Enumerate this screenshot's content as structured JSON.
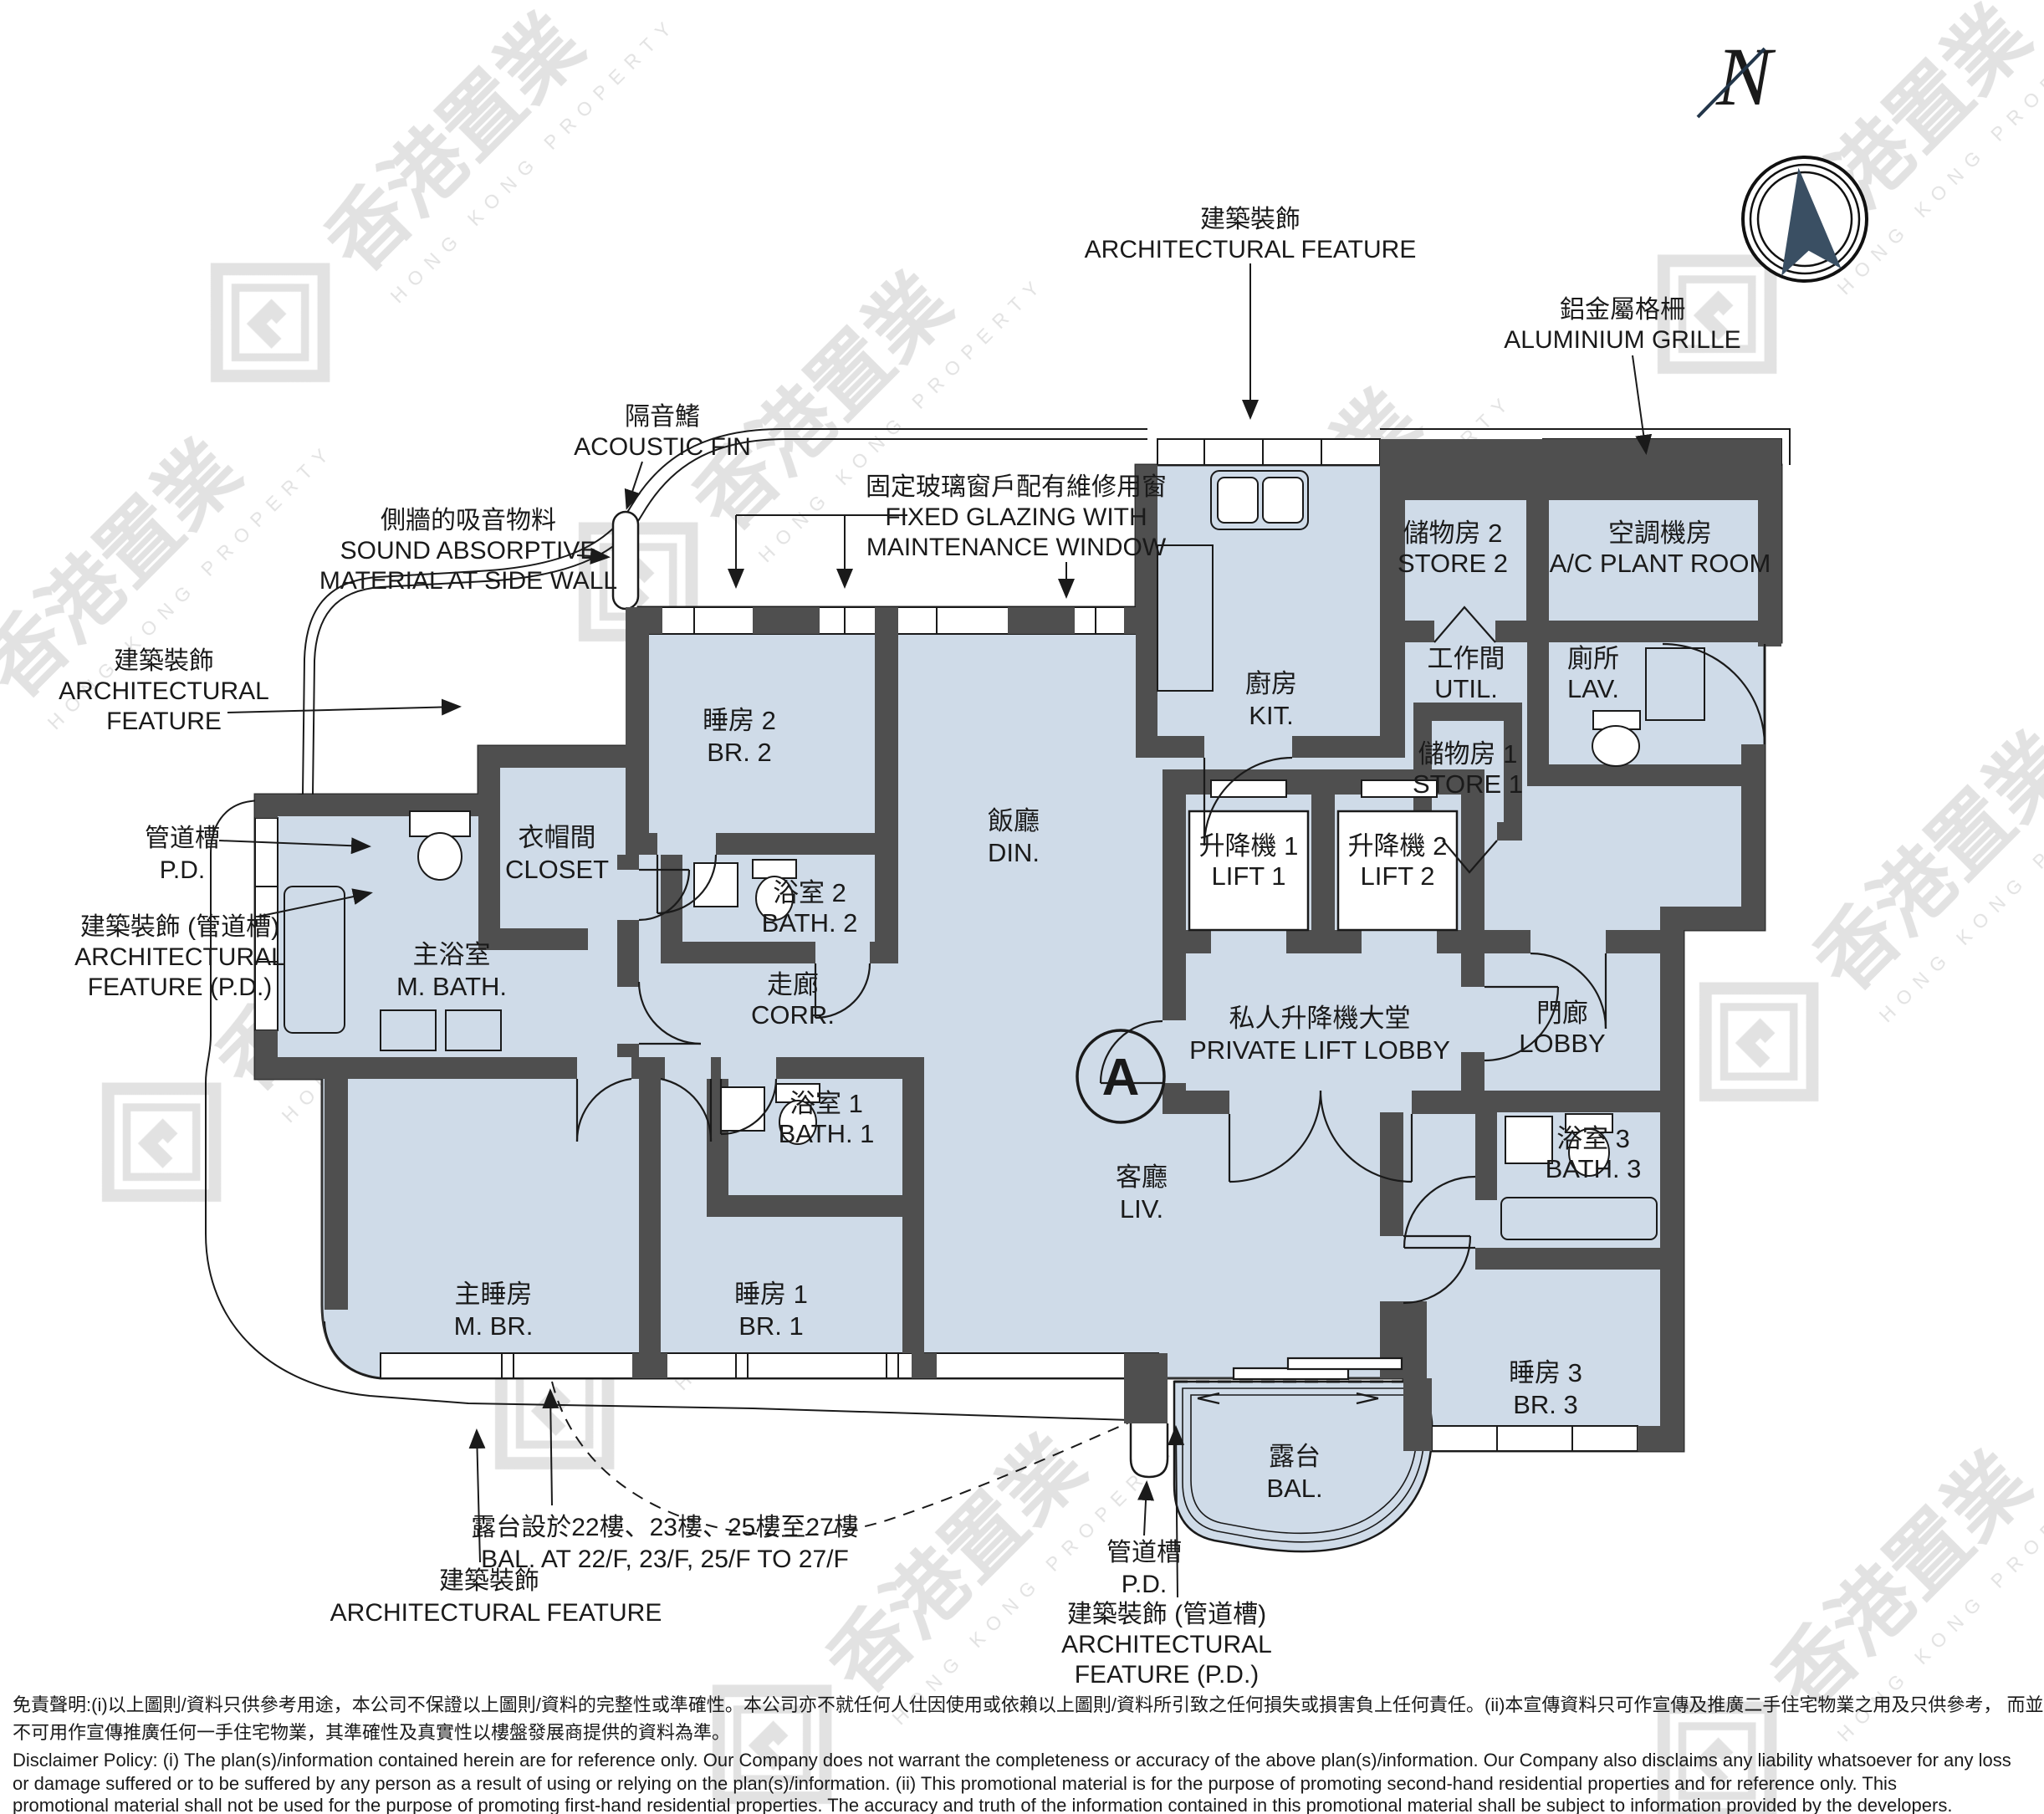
{
  "unit": {
    "marker": "A"
  },
  "compass": {
    "n": "N"
  },
  "watermark": {
    "cjk": "香港置業",
    "en": "HONG KONG PROPERTY"
  },
  "colors": {
    "floor": "#cfdbe8",
    "wall": "#4f4f4f",
    "needle": "#3a4f63",
    "line": "#1a1a1a"
  },
  "rooms": {
    "kit": {
      "zh": "廚房",
      "en": "KIT."
    },
    "store2": {
      "zh": "儲物房 2",
      "en": "STORE 2"
    },
    "acpr": {
      "zh": "空調機房",
      "en": "A/C PLANT ROOM"
    },
    "util": {
      "zh": "工作間",
      "en": "UTIL."
    },
    "lav": {
      "zh": "廁所",
      "en": "LAV."
    },
    "store1": {
      "zh": "儲物房 1",
      "en": "STORE 1"
    },
    "br2": {
      "zh": "睡房 2",
      "en": "BR. 2"
    },
    "din": {
      "zh": "飯廳",
      "en": "DIN."
    },
    "closet": {
      "zh": "衣帽間",
      "en": "CLOSET"
    },
    "mbath": {
      "zh": "主浴室",
      "en": "M. BATH."
    },
    "bath2": {
      "zh": "浴室 2",
      "en": "BATH. 2"
    },
    "corr": {
      "zh": "走廊",
      "en": "CORR."
    },
    "lift1": {
      "zh": "升降機 1",
      "en": "LIFT 1"
    },
    "lift2": {
      "zh": "升降機 2",
      "en": "LIFT 2"
    },
    "pll": {
      "zh": "私人升降機大堂",
      "en": "PRIVATE LIFT LOBBY"
    },
    "lobby": {
      "zh": "門廊",
      "en": "LOBBY"
    },
    "bath3": {
      "zh": "浴室 3",
      "en": "BATH. 3"
    },
    "bath1": {
      "zh": "浴室 1",
      "en": "BATH. 1"
    },
    "mbr": {
      "zh": "主睡房",
      "en": "M. BR."
    },
    "br1": {
      "zh": "睡房 1",
      "en": "BR. 1"
    },
    "liv": {
      "zh": "客廳",
      "en": "LIV."
    },
    "br3": {
      "zh": "睡房 3",
      "en": "BR. 3"
    },
    "bal": {
      "zh": "露台",
      "en": "BAL."
    }
  },
  "annotations": {
    "af_top": {
      "zh": "建築裝飾",
      "en": "ARCHITECTURAL FEATURE"
    },
    "alu_grille": {
      "zh": "鋁金屬格柵",
      "en": "ALUMINIUM GRILLE"
    },
    "acoustic": {
      "zh": "隔音鰭",
      "en": "ACOUSTIC FIN"
    },
    "fixed_glz": {
      "zh": "固定玻璃窗戶配有維修用窗",
      "en1": "FIXED GLAZING WITH",
      "en2": "MAINTENANCE WINDOW"
    },
    "sound_abs": {
      "zh": "側牆的吸音物料",
      "en1": "SOUND ABSORPTIVE",
      "en2": "MATERIAL AT SIDE WALL"
    },
    "af_left": {
      "zh": "建築裝飾",
      "en1": "ARCHITECTURAL",
      "en2": "FEATURE"
    },
    "pd_left": {
      "zh": "管道槽",
      "en": "P.D."
    },
    "afpd_left": {
      "zh": "建築裝飾 (管道槽)",
      "en1": "ARCHITECTURAL",
      "en2": "FEATURE (P.D.)"
    },
    "af_bottom": {
      "zh": "建築裝飾",
      "en": "ARCHITECTURAL FEATURE"
    },
    "bal_at": {
      "zh": "露台設於22樓、23樓、25樓至27樓",
      "en": "BAL. AT 22/F, 23/F, 25/F TO 27/F"
    },
    "pd_bottom": {
      "zh": "管道槽",
      "en": "P.D."
    },
    "afpd_bottom": {
      "zh": "建築裝飾 (管道槽)",
      "en1": "ARCHITECTURAL",
      "en2": "FEATURE (P.D.)"
    }
  },
  "disclaimer": {
    "zh1": "免責聲明:(i)以上圖則/資料只供參考用途，本公司不保證以上圖則/資料的完整性或準確性。本公司亦不就任何人仕因使用或依賴以上圖則/資料所引致之任何損失或損害負上任何責任。(ii)本宣傳資料只可作宣傳及推廣二手住宅物業之用及只供參考， 而並非及",
    "zh2": "不可用作宣傳推廣任何一手住宅物業，其準確性及真實性以樓盤發展商提供的資料為準。",
    "en1": "Disclaimer Policy: (i) The plan(s)/information contained herein are for reference only. Our Company does not warrant the completeness or accuracy of the above plan(s)/information. Our Company also disclaims any liability whatsoever for any loss",
    "en2": "or damage suffered or to be suffered by any person as a result of using or relying on the plan(s)/information. (ii) This promotional material is for the purpose of promoting second-hand residential properties and for reference only. This",
    "en3": "promotional material shall not be used for the purpose of promoting first-hand residential properties. The accuracy and truth of the information contained in this promotional material shall be subject to information provided by the developers."
  }
}
